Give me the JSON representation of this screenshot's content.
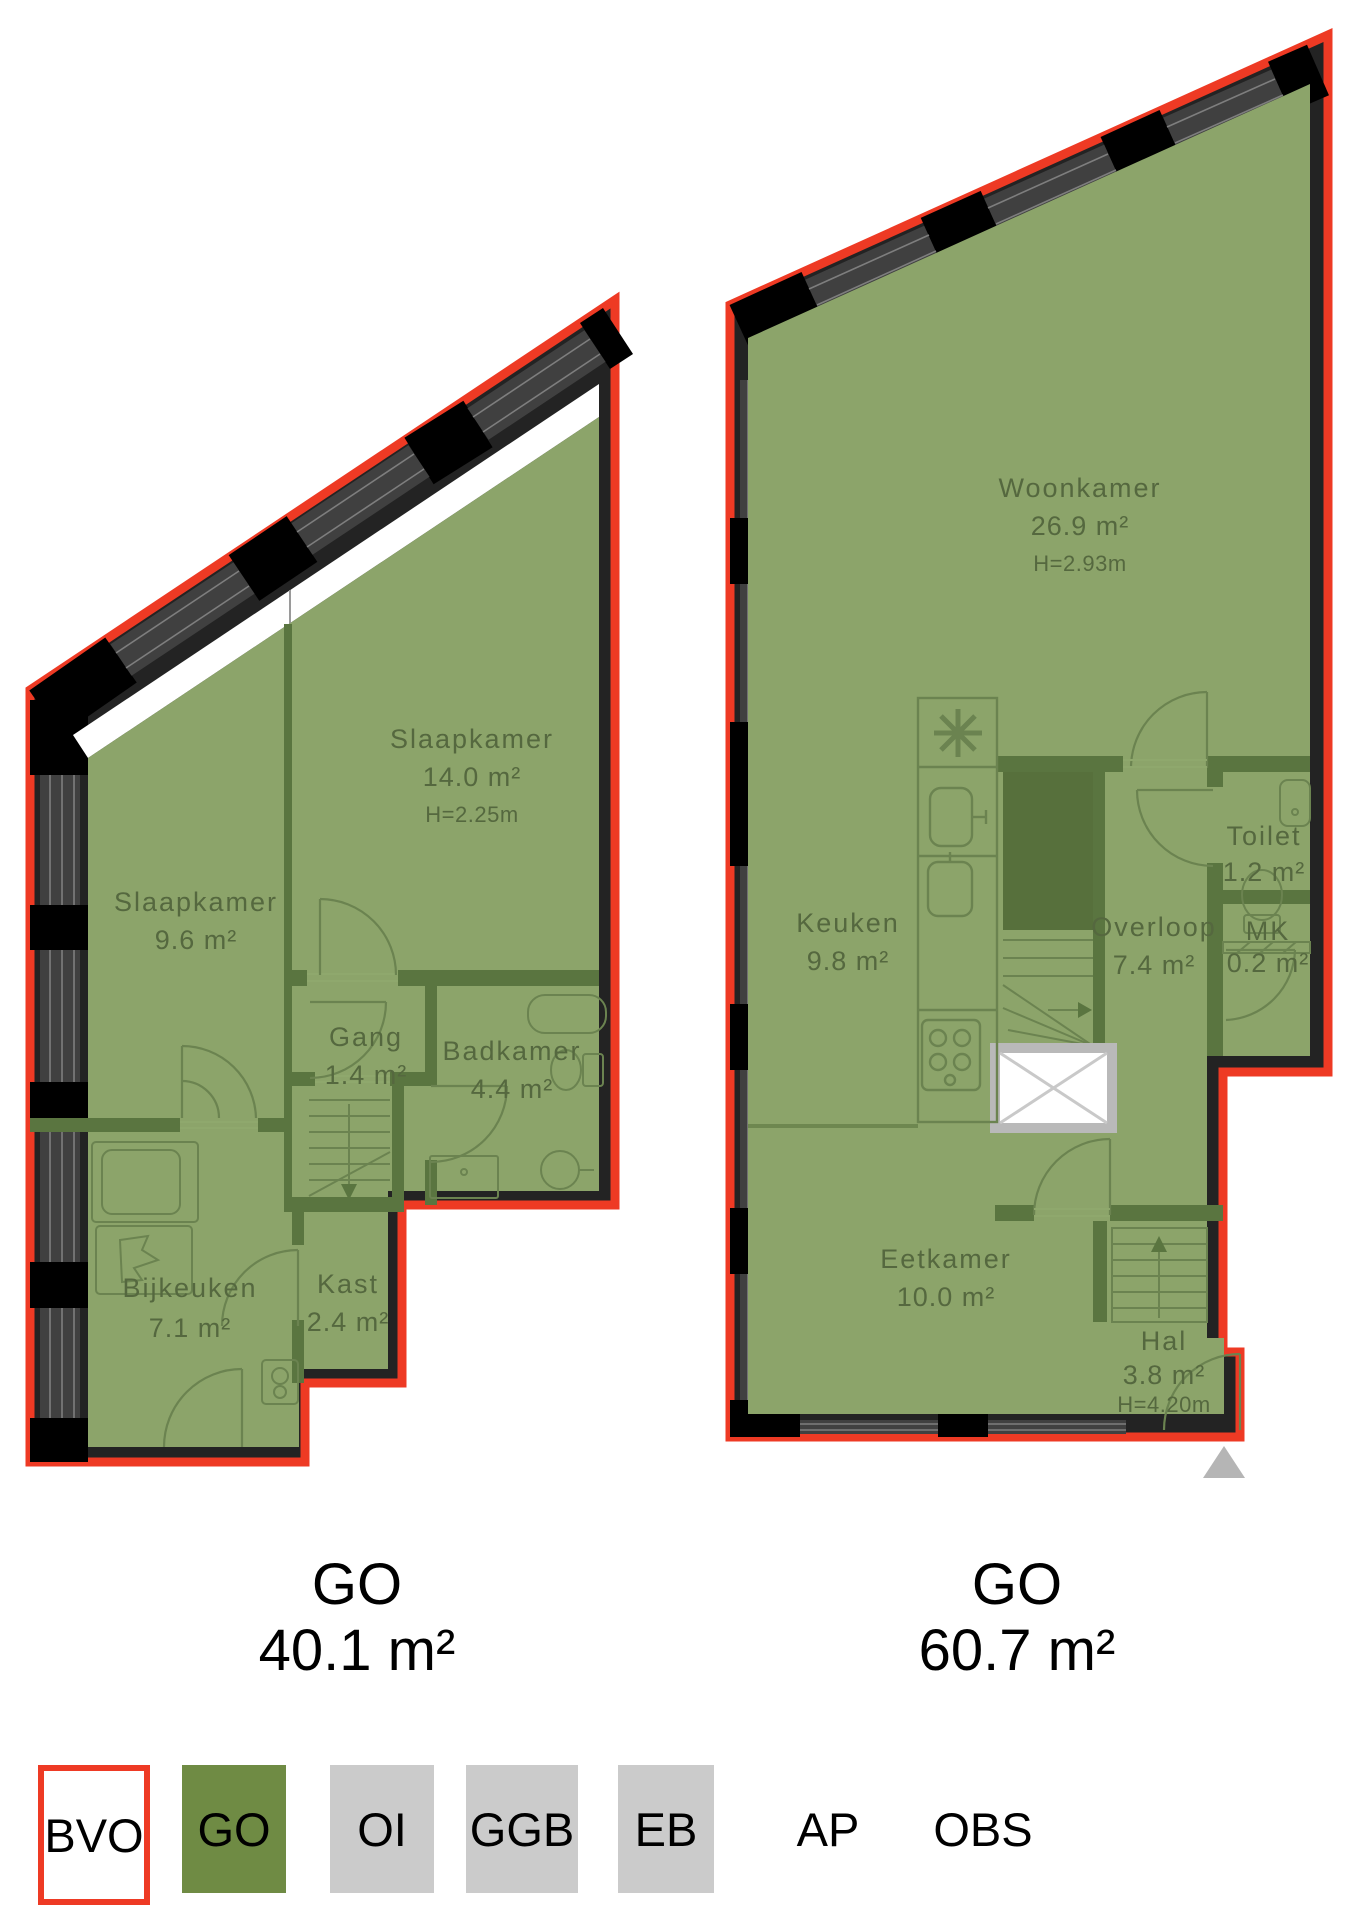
{
  "page": {
    "type": "floorplan-drawing"
  },
  "plans": [
    {
      "id": "floor-left",
      "summary": {
        "label": "GO",
        "area": "40.1 m²"
      },
      "rooms": [
        {
          "name": "Slaapkamer",
          "area": "9.6 m²"
        },
        {
          "name": "Slaapkamer",
          "area": "14.0 m²",
          "height": "H=2.25m"
        },
        {
          "name": "Gang",
          "area": "1.4 m²"
        },
        {
          "name": "Badkamer",
          "area": "4.4 m²"
        },
        {
          "name": "Bijkeuken",
          "area": "7.1 m²"
        },
        {
          "name": "Kast",
          "area": "2.4 m²"
        }
      ]
    },
    {
      "id": "floor-right",
      "summary": {
        "label": "GO",
        "area": "60.7 m²"
      },
      "rooms": [
        {
          "name": "Woonkamer",
          "area": "26.9 m²",
          "height": "H=2.93m"
        },
        {
          "name": "Keuken",
          "area": "9.8 m²"
        },
        {
          "name": "Overloop",
          "area": "7.4 m²"
        },
        {
          "name": "Toilet",
          "area": "1.2 m²"
        },
        {
          "name": "MK",
          "area": "0.2 m²"
        },
        {
          "name": "Eetkamer",
          "area": "10.0 m²"
        },
        {
          "name": "Hal",
          "area": "3.8 m²",
          "height": "H=4.20m"
        }
      ]
    }
  ],
  "legend": {
    "items": [
      {
        "label": "BVO",
        "swatch": "outline-red"
      },
      {
        "label": "GO",
        "swatch": "green"
      },
      {
        "label": "OI",
        "swatch": "gray"
      },
      {
        "label": "GGB",
        "swatch": "gray"
      },
      {
        "label": "EB",
        "swatch": "gray"
      },
      {
        "label": "AP",
        "swatch": "none"
      },
      {
        "label": "OBS",
        "swatch": "none"
      }
    ]
  },
  "colors": {
    "bvo_outline_red": "#ee3a24",
    "go_fill_green": "#8ca46a",
    "interior_wall_green": "#5a7540",
    "legend_go_green": "#6f8b44",
    "legend_gray": "#cbcbcb",
    "exterior_wall": "#232323"
  }
}
